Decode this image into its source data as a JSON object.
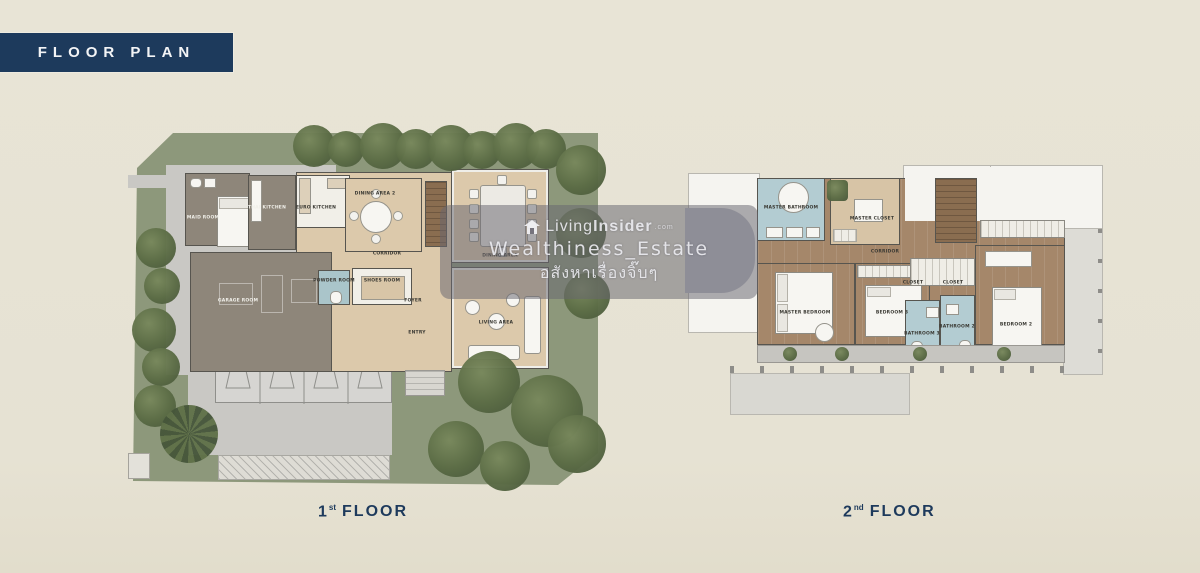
{
  "badge": {
    "label": "FLOOR PLAN"
  },
  "watermark": {
    "brand_pre": "Living",
    "brand_bold": "Insider",
    "brand_tld": ".com",
    "line2": "Wealthiness_Estate",
    "line3": "อสังหาเรื่องจิ๊บๆ"
  },
  "colors": {
    "accent_navy": "#1d3a5c",
    "lawn_green": "#8d987b",
    "house_taupe": "#8e867a",
    "room_tan": "#d9c6a8",
    "bath_blue": "#b3ccd2",
    "wood_floor": "#a5876a",
    "driveway_gray": "#c9c8c4",
    "watermark_overlay": "#686670"
  },
  "floors": {
    "floor1": {
      "caption": {
        "number": "1",
        "ordinal": "st",
        "word": "FLOOR"
      },
      "rooms": {
        "maid": "MAID ROOM",
        "thai_kitchen": "THAI KITCHEN",
        "euro_kitchen": "EURO KITCHEN",
        "dining2": "DINING AREA 2",
        "dining": "DINING AREA",
        "corridor": "CORRIDOR",
        "garage": "GARAGE ROOM",
        "powder": "POWDER ROOM",
        "shoes": "SHOES ROOM",
        "foyer": "FOYER",
        "entry": "ENTRY",
        "living": "LIVING AREA"
      }
    },
    "floor2": {
      "caption": {
        "number": "2",
        "ordinal": "nd",
        "word": "FLOOR"
      },
      "rooms": {
        "master_bathroom": "MASTER BATHROOM",
        "master_closet": "MASTER CLOSET",
        "corridor": "CORRIDOR",
        "master_bedroom": "MASTER BEDROOM",
        "bedroom3": "BEDROOM 3",
        "closet_a": "CLOSET",
        "closet_b": "CLOSET",
        "bathroom3": "BATHROOM 3",
        "bathroom2": "BATHROOM 2",
        "bedroom2": "BEDROOM 2"
      }
    }
  }
}
